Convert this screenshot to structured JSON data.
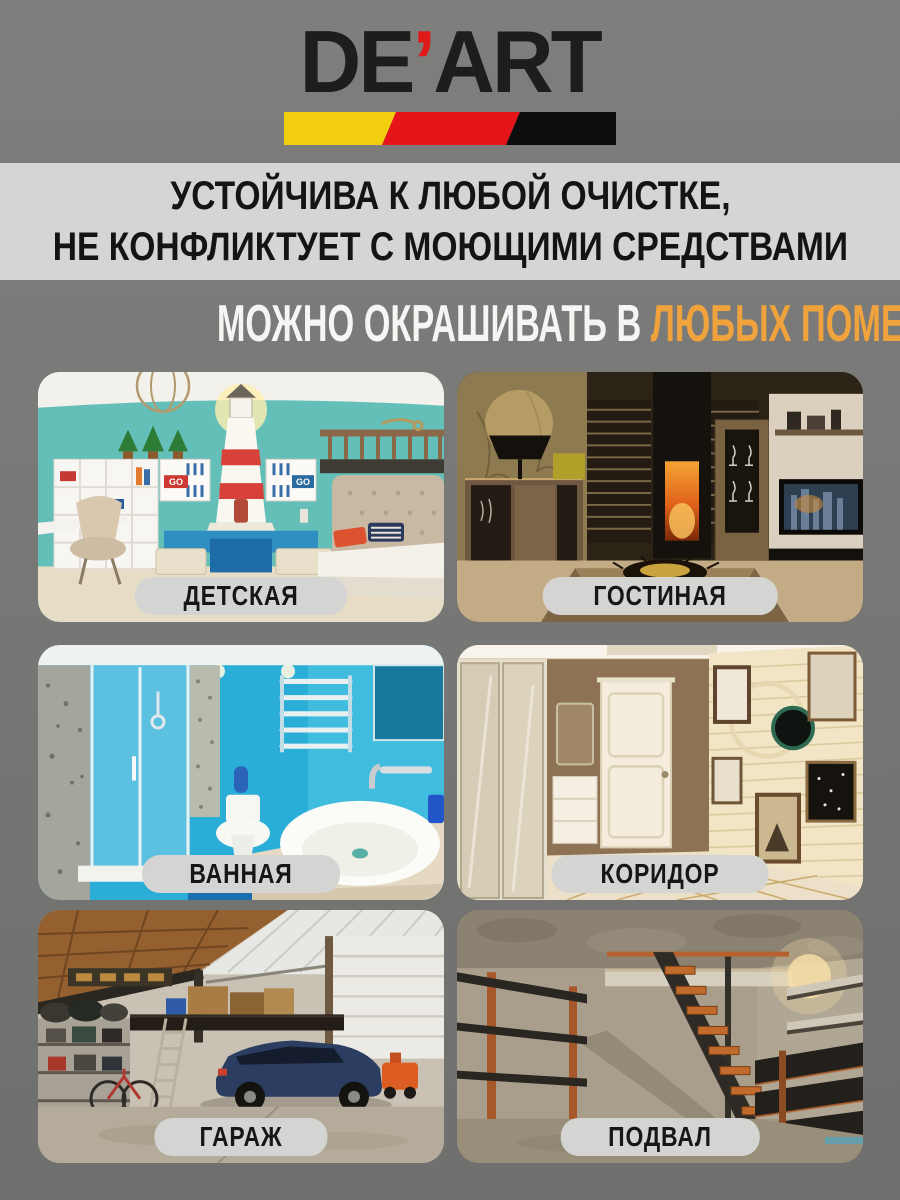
{
  "logo": {
    "part1": "DE",
    "apostrophe": "’",
    "part2": "ART"
  },
  "banner": {
    "line1": "УСТОЙЧИВА К ЛЮБОЙ ОЧИСТКЕ,",
    "line2": "НЕ КОНФЛИКТУЕТ С МОЮЩИМИ СРЕДСТВАМИ"
  },
  "headline": {
    "prefix": "МОЖНО ОКРАШИВАТЬ В ",
    "highlight": "ЛЮБЫХ ПОМЕЩЕНИЯХ"
  },
  "rooms": [
    {
      "label": "ДЕТСКАЯ"
    },
    {
      "label": "ГОСТИНАЯ"
    },
    {
      "label": "ВАННАЯ"
    },
    {
      "label": "КОРИДОР"
    },
    {
      "label": "ГАРАЖ"
    },
    {
      "label": "ПОДВАЛ"
    }
  ],
  "photo_texts": {
    "kids_box_decal": "GO"
  },
  "colors": {
    "accent_orange": "#f0a33c",
    "band_bg": "#d5d5d3",
    "pill_bg": "#d4d4d2",
    "logo_red": "#e01a18",
    "logo_yellow": "#f2cf0e",
    "logo_black": "#0e0e0e",
    "page_gray": "#7a7a78"
  }
}
